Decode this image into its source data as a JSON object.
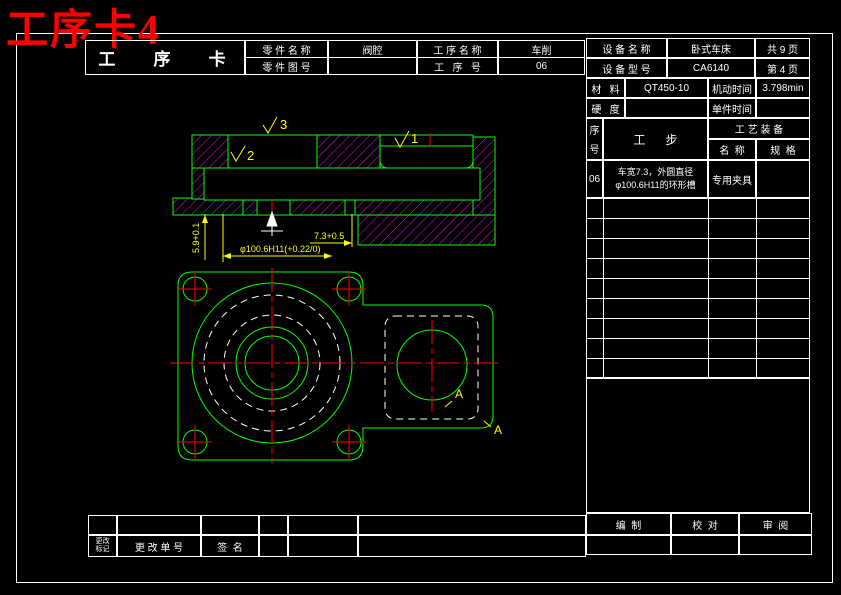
{
  "title": {
    "text": "工序卡4",
    "color": "#ff0000"
  },
  "card": {
    "title": "工   序   卡",
    "part_name_label": "零 件 名 称",
    "part_name_value": "阀腔",
    "process_name_label": "工 序 名 称",
    "process_name_value": "车削",
    "part_no_label": "零 件 图 号",
    "part_no_value": "",
    "process_no_label": "工   序   号",
    "process_no_value": "06"
  },
  "equipment": {
    "name_label": "设 备 名 称",
    "name_value": "卧式车床",
    "pages_total": "共 9 页",
    "model_label": "设 备 型 号",
    "model_value": "CA6140",
    "page_current": "第 4 页",
    "material_label": "材   料",
    "material_value": "QT450-10",
    "machine_time_label": "机动时间",
    "machine_time_value": "3.798min",
    "hardness_label": "硬   度",
    "hardness_value": "",
    "unit_time_label": "单件时间",
    "unit_time_value": ""
  },
  "steps": {
    "seq_char1": "序",
    "seq_char2": "号",
    "step_header": "工      步",
    "tooling_header": "工 艺 装 备",
    "tool_name_header": "名  称",
    "tool_spec_header": "规  格",
    "rows": [
      {
        "seq": "06",
        "description": "车宽7.3，外圆直径φ100.6H11的环形槽",
        "tool_name": "专用夹具",
        "tool_spec": ""
      }
    ]
  },
  "footer": {
    "change_mark_line1": "更改",
    "change_mark_line2": "标记",
    "change_no_label": "更 改 单 号",
    "signature_label": "签  名",
    "compile_label": "编  制",
    "proofread_label": "校  对",
    "review_label": "审  阅"
  },
  "drawing": {
    "dim_groove_depth": "5.9+0.1",
    "dim_groove_width": "7.3+0.5",
    "dim_diameter": "φ100.6H11(+0.22/0)",
    "finish_mark_3": "3",
    "finish_mark_2": "2",
    "finish_mark_1": "1",
    "section_label_a1": "A",
    "section_label_a2": "A",
    "colors": {
      "outline": "#00ff00",
      "hatch": "#ff00ff",
      "centerline": "#ff0000",
      "dimension": "#ffff00",
      "hidden_line": "#ffffff"
    }
  }
}
